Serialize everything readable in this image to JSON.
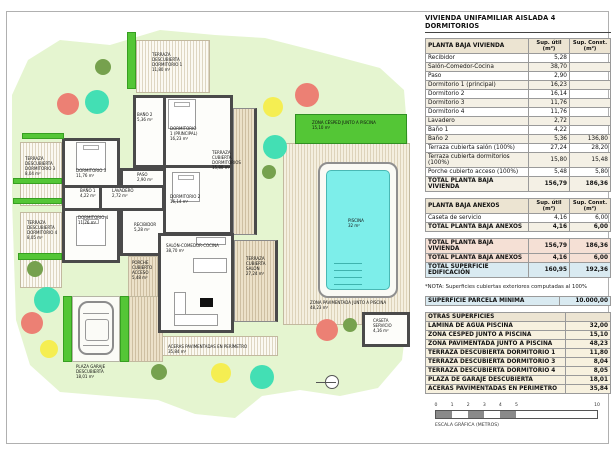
{
  "sheet": {
    "title": "VIVIENDA UNIFAMILIAR AISLADA 4 DORMITORIOS"
  },
  "tables": {
    "col_util": "Sup. útil\n(m²)",
    "col_const": "Sup. Const.\n(m²)",
    "vivienda": {
      "title": "PLANTA BAJA VIVIENDA",
      "rows": [
        [
          "Recibidor",
          "5,28",
          ""
        ],
        [
          "Salón-Comedor-Cocina",
          "38,70",
          ""
        ],
        [
          "Paso",
          "2,90",
          ""
        ],
        [
          "Dormitorio 1 (principal)",
          "16,23",
          ""
        ],
        [
          "Dormitorio 2",
          "16,14",
          ""
        ],
        [
          "Dormitorio 3",
          "11,76",
          ""
        ],
        [
          "Dormitorio 4",
          "11,76",
          ""
        ],
        [
          "Lavadero",
          "2,72",
          ""
        ],
        [
          "Baño 1",
          "4,22",
          ""
        ],
        [
          "Baño 2",
          "5,36",
          "136,80"
        ],
        [
          "Terraza cubierta salón (100%)",
          "27,24",
          "28,20"
        ],
        [
          "Terraza cubierta dormitorios (100%)",
          "15,80",
          "15,48"
        ],
        [
          "Porche cubierto acceso (100%)",
          "5,48",
          "5,80"
        ],
        {
          "cells": [
            "TOTAL PLANTA BAJA VIVIENDA",
            "156,79",
            "186,36"
          ],
          "cls": "row-total"
        }
      ]
    },
    "anexos": {
      "title": "PLANTA BAJA ANEXOS",
      "rows": [
        [
          "Caseta de servicio",
          "4,16",
          "6,00"
        ],
        {
          "cells": [
            "TOTAL PLANTA BAJA ANEXOS",
            "4,16",
            "6,00"
          ],
          "cls": "row-total"
        }
      ]
    },
    "resumen": {
      "rows": [
        {
          "cells": [
            "TOTAL PLANTA BAJA VIVIENDA",
            "156,79",
            "186,36"
          ],
          "cls": "row-total"
        },
        {
          "cells": [
            "TOTAL PLANTA BAJA ANEXOS",
            "4,16",
            "6,00"
          ],
          "cls": "row-total"
        },
        {
          "cells": [
            "TOTAL SUPERFICIE EDIFICACIÓN",
            "160,95",
            "192,36"
          ],
          "cls": "row-blue"
        }
      ]
    },
    "nota": "*NOTA: Superficies cubiertas exteriores computadas al 100%",
    "parcela": {
      "rows": [
        {
          "cells": [
            "SUPERFICIE PARCELA MÍNIMA",
            "10.000,00"
          ],
          "cls": "row-blue"
        }
      ]
    },
    "otras": {
      "title": "OTRAS SUPERFICIES",
      "rows": [
        [
          "LÁMINA DE AGUA PISCINA",
          "32,00"
        ],
        [
          "ZONA CÉSPED JUNTO A PISCINA",
          "15,10"
        ],
        [
          "ZONA PAVIMENTADA JUNTO A PISCINA",
          "48,23"
        ],
        [
          "TERRAZA DESCUBIERTA DORMITORIO 1",
          "11,80"
        ],
        [
          "TERRAZA DESCUBIERTA DORMITORIO 3",
          "8,04"
        ],
        [
          "TERRAZA DESCUBIERTA DORMITORIO 4",
          "8,05"
        ],
        [
          "PLAZA DE GARAJE DESCUBIERTA",
          "18,01"
        ],
        [
          "ACERAS PAVIMENTADAS EN PERÍMETRO",
          "35,84"
        ]
      ]
    }
  },
  "plan": {
    "labels": {
      "tdd1": "TERRAZA\nDESCUBIERTA\nDORMITORIO 1\n11,80 m²",
      "tdd3": "TERRAZA\nDESCUBIERTA\nDORMITORIO 3\n8,04 m²",
      "tdd4": "TERRAZA\nDESCUBIERTA\nDORMITORIO 4\n8,05 m²",
      "bano2": "BAÑO 2\n5,36 m²",
      "dorm1": "DORMITORIO\n1 (PRINCIPAL)\n16,23 m²",
      "tcd": "TERRAZA\nCUBIERTA\nDORMITORIOS\n15,80 m²",
      "dorm3": "DORMITORIO 3\n11,76 m²",
      "paso": "PASO\n2,90 m²",
      "bano1": "BAÑO 1\n4,22 m²",
      "lavadero": "LAVADERO\n2,72 m²",
      "dorm2": "DORMITORIO 2\n16,14 m²",
      "dorm4": "DORMITORIO 4\n11,76 m²",
      "recibidor": "RECIBIDOR\n5,28 m²",
      "salon": "SALÓN-COMEDOR-COCINA\n38,70 m²",
      "porche": "PORCHE\nCUBIERTO\nACCESO\n5,48 m²",
      "tcs": "TERRAZA\nCUBIERTA\nSALÓN\n27,24 m²",
      "cesped": "ZONA CÉSPED JUNTO A PISCINA\n15,10 m²",
      "piscina": "PISCINA\n32 m²",
      "pavimentada": "ZONA PAVIMENTADA JUNTO A PISCINA\n48,23 m²",
      "caseta": "CASETA\nSERVICIO\n4,16 m²",
      "garaje": "PLAZA GARAJE\nDESCUBIERTA\n18,01 m²",
      "aceras": "ACERAS PAVIMENTADAS EN PERÍMETRO\n35,84 m²"
    }
  },
  "scale": {
    "ticks": [
      "0",
      "1",
      "2",
      "3",
      "4",
      "5",
      "10"
    ],
    "dark_segments": [
      [
        0,
        1
      ],
      [
        2,
        3
      ],
      [
        4,
        5
      ]
    ],
    "label": "ESCALA GRÁFICA (METROS)"
  },
  "colors": {
    "landscape_green": "#e5f5d0",
    "cesped_green": "#54c636",
    "tree_red": "#ec8074",
    "tree_teal": "#43dfb4",
    "tree_yellow": "#f5ee52",
    "tree_olive": "#76a14e",
    "pool_cyan": "#7deeea",
    "wall_gray": "#4a4a4a",
    "header_tan": "#ece4d2",
    "total_pink": "#f5e0d5",
    "total_blue": "#d9eaf1",
    "otras_cream": "#f7f1df"
  }
}
